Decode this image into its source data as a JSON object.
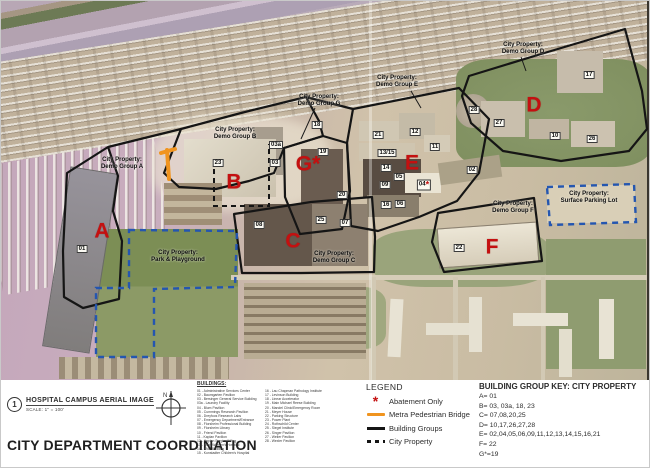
{
  "sheet": {
    "figure_number": "1",
    "figure_title": "HOSPITAL CAMPUS AERIAL IMAGE",
    "figure_scale": "SCALE: 1\" = 100'",
    "sheet_title": "CITY DEPARTMENT COORDINATION",
    "north_label": "N"
  },
  "buildings_list": {
    "heading": "BUILDINGS:",
    "col1": [
      "01 - Administrative Services Center",
      "02 - Baumgarten Pavilion",
      "03 - Bersinger General Service Building",
      "03a - Laundry Facility",
      "04 - Blum Pavilion",
      "05 - Cummings Research Pavilion",
      "06 - Dreyfoos Research Labs",
      "07 - Emergency Department/Entrance",
      "08 - Florsheim Professional Building",
      "09 - Florsheim Library",
      "10 - Friend Pavilion",
      "11 - Kaplan Pavilion",
      "12 - Kaplan Surgical Wing",
      "13 - Klein Women's Hospital",
      "14 - KND Building",
      "15 - Kunstadter Children's Hospital"
    ],
    "col2": [
      "16 - Lau Chapman Pathology Institute",
      "17 - Levinson Building",
      "18 - Linear Accelerator",
      "19 - Main Michael Reese Building",
      "20 - Mandel Clinic/Emergency Room",
      "21 - Meyer House",
      "22 - Parking Structure",
      "23 - Power Plant",
      "24 - Rothschild Center",
      "25 - Siegel Institute",
      "26 - Singer Pavilion",
      "27 - Weiler Pavilion",
      "28 - Wexler Pavilion"
    ]
  },
  "legend": {
    "heading": "LEGEND",
    "items": [
      {
        "symbol": "asterisk",
        "label": "Abatement Only"
      },
      {
        "symbol": "orange-line",
        "label": "Metra Pedestrian Bridge"
      },
      {
        "symbol": "solid-line",
        "label": "Building Groups"
      },
      {
        "symbol": "dashed-line",
        "label": "City Property"
      }
    ]
  },
  "building_group_key": {
    "heading": "BUILDING GROUP KEY: CITY PROPERTY",
    "entries": [
      "A= 01",
      "B= 03, 03a, 18, 23",
      "C= 07,08,20,25",
      "D= 10,17,26,27,28",
      "E= 02,04,05,06,09,11,12,13,14,15,16,21",
      "F= 22",
      "G*=19"
    ]
  },
  "map": {
    "group_letters": [
      {
        "letter": "A",
        "x": 101,
        "y": 230
      },
      {
        "letter": "B",
        "x": 233,
        "y": 181
      },
      {
        "letter": "C",
        "x": 292,
        "y": 240
      },
      {
        "letter": "D",
        "x": 533,
        "y": 104
      },
      {
        "letter": "E",
        "x": 411,
        "y": 162
      },
      {
        "letter": "F",
        "x": 491,
        "y": 246
      },
      {
        "letter": "G*",
        "x": 307,
        "y": 163
      }
    ],
    "area_labels": [
      {
        "lines": [
          "City Property:",
          "Demo Group A"
        ],
        "x": 121,
        "y": 163
      },
      {
        "lines": [
          "City Property:",
          "Demo Group B"
        ],
        "x": 234,
        "y": 133
      },
      {
        "lines": [
          "City Property:",
          "Demo Group C"
        ],
        "x": 333,
        "y": 257
      },
      {
        "lines": [
          "City Property:",
          "Demo Group D"
        ],
        "x": 522,
        "y": 48
      },
      {
        "lines": [
          "City Property:",
          "Demo Group E"
        ],
        "x": 396,
        "y": 81
      },
      {
        "lines": [
          "City Property:",
          "Demo Group F"
        ],
        "x": 512,
        "y": 207
      },
      {
        "lines": [
          "City Property:",
          "Demo Group G"
        ],
        "x": 318,
        "y": 100
      },
      {
        "lines": [
          "City Property:",
          "Surface Parking Lot"
        ],
        "x": 588,
        "y": 197
      },
      {
        "lines": [
          "City Property:",
          "Park & Playground"
        ],
        "x": 177,
        "y": 256
      }
    ],
    "building_numbers": [
      {
        "label": "01",
        "x": 81,
        "y": 248
      },
      {
        "label": "23",
        "x": 217,
        "y": 162
      },
      {
        "label": "03a",
        "x": 275,
        "y": 144
      },
      {
        "label": "03",
        "x": 274,
        "y": 162
      },
      {
        "label": "18",
        "x": 316,
        "y": 124
      },
      {
        "label": "19",
        "x": 322,
        "y": 151
      },
      {
        "label": "08",
        "x": 258,
        "y": 224
      },
      {
        "label": "25",
        "x": 320,
        "y": 219
      },
      {
        "label": "07",
        "x": 344,
        "y": 222
      },
      {
        "label": "20",
        "x": 341,
        "y": 194
      },
      {
        "label": "21",
        "x": 377,
        "y": 134
      },
      {
        "label": "12",
        "x": 414,
        "y": 131
      },
      {
        "label": "13/15",
        "x": 386,
        "y": 152
      },
      {
        "label": "11",
        "x": 434,
        "y": 146
      },
      {
        "label": "14",
        "x": 385,
        "y": 167
      },
      {
        "label": "05",
        "x": 398,
        "y": 176
      },
      {
        "label": "09",
        "x": 384,
        "y": 184
      },
      {
        "label": "16",
        "x": 385,
        "y": 204
      },
      {
        "label": "06",
        "x": 399,
        "y": 203
      },
      {
        "label": "04",
        "x": 423,
        "y": 184,
        "asterisk": true
      },
      {
        "label": "02",
        "x": 471,
        "y": 169
      },
      {
        "label": "22",
        "x": 458,
        "y": 247
      },
      {
        "label": "17",
        "x": 588,
        "y": 74
      },
      {
        "label": "28",
        "x": 473,
        "y": 109
      },
      {
        "label": "27",
        "x": 498,
        "y": 122
      },
      {
        "label": "10",
        "x": 554,
        "y": 135
      },
      {
        "label": "26",
        "x": 591,
        "y": 138
      }
    ],
    "colors": {
      "group_letter": "#c41010",
      "metra_bridge": "#f0941f",
      "building_groups_line": "#151515",
      "city_property_line": "#2456b0"
    }
  }
}
